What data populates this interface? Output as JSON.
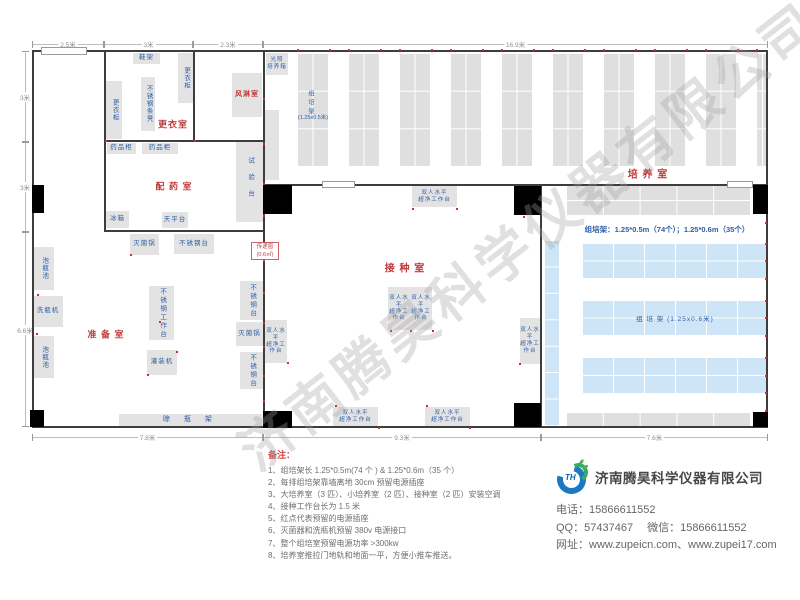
{
  "watermark": "济南腾昊科学仪器有限公司",
  "plan": {
    "colors": {
      "wall": "#3d3d3d",
      "equip_gray": "#e3e3e3",
      "rack_gray": "#dfdfdf",
      "rack_blue": "#cde5f6",
      "label_blue": "#2e5fa6",
      "accent_red": "#c03a3a",
      "outlet_red": "#d12f2f"
    },
    "walls": [
      [
        32,
        50,
        736,
        2
      ],
      [
        32,
        426,
        736,
        2
      ],
      [
        32,
        50,
        2,
        378
      ],
      [
        766,
        50,
        2,
        378
      ],
      [
        104,
        51,
        2,
        181
      ],
      [
        193,
        51,
        2,
        91
      ],
      [
        105,
        140,
        160,
        2
      ],
      [
        105,
        230,
        160,
        2
      ],
      [
        263,
        51,
        2,
        376
      ],
      [
        264,
        184,
        504,
        2
      ],
      [
        540,
        186,
        2,
        241
      ]
    ],
    "doors": [
      [
        32,
        185,
        12,
        28
      ],
      [
        30,
        410,
        14,
        17
      ],
      [
        263,
        185,
        29,
        29
      ],
      [
        263,
        411,
        29,
        17
      ],
      [
        514,
        186,
        27,
        29
      ],
      [
        514,
        403,
        27,
        24
      ],
      [
        753,
        185,
        15,
        29
      ],
      [
        753,
        412,
        15,
        15
      ]
    ],
    "openings": [
      [
        41,
        47,
        46,
        8
      ],
      [
        322,
        181,
        33,
        7
      ],
      [
        727,
        181,
        26,
        7
      ]
    ],
    "rack_columns": {
      "y": 53,
      "h": 113,
      "w": 31,
      "rows": 3,
      "cols": 2,
      "clip": 768,
      "xs": [
        297,
        348,
        399,
        450,
        501,
        552,
        603,
        654,
        705,
        756
      ]
    },
    "grids": [
      {
        "x": 566,
        "y": 185,
        "w": 184,
        "h": 30,
        "r": 2,
        "c": 5,
        "b": "g"
      },
      {
        "x": 566,
        "y": 412,
        "w": 184,
        "h": 15,
        "r": 1,
        "c": 5,
        "b": "g"
      },
      {
        "x": 582,
        "y": 243,
        "w": 186,
        "h": 35,
        "r": 2,
        "c": 6,
        "b": "b"
      },
      {
        "x": 582,
        "y": 300,
        "w": 186,
        "h": 35,
        "r": 2,
        "c": 6,
        "b": "b",
        "t": "组 培 架 (1.25x0.6米)"
      },
      {
        "x": 582,
        "y": 357,
        "w": 186,
        "h": 36,
        "r": 2,
        "c": 6,
        "b": "b"
      },
      {
        "x": 544,
        "y": 240,
        "w": 15,
        "h": 185,
        "r": 7,
        "c": 1,
        "b": "b"
      }
    ],
    "equipment": [
      {
        "n": "shoe-rack",
        "t": "鞋架",
        "x": 133,
        "y": 53,
        "w": 27,
        "h": 11
      },
      {
        "n": "wardrobe",
        "t": "更衣柜",
        "x": 178,
        "y": 53,
        "w": 15,
        "h": 50,
        "v": 1
      },
      {
        "n": "steel-strip-bench",
        "t": "不锈钢条凳",
        "x": 141,
        "y": 77,
        "w": 14,
        "h": 54,
        "v": 1
      },
      {
        "n": "wardrobe",
        "t": "更衣柜",
        "x": 106,
        "y": 81,
        "w": 16,
        "h": 58,
        "v": 1
      },
      {
        "n": "air-shower",
        "t": "风淋室",
        "x": 232,
        "y": 73,
        "w": 30,
        "h": 44,
        "red": 1,
        "fs": 7
      },
      {
        "n": "light-incubator",
        "t": "光照\n培养箱",
        "x": 266,
        "y": 53,
        "w": 22,
        "h": 22,
        "fs": 5.5
      },
      {
        "n": "culture-rack",
        "t": "",
        "x": 265,
        "y": 110,
        "w": 14,
        "h": 70
      },
      {
        "n": "medicine-cabinet",
        "t": "药品柜",
        "x": 107,
        "y": 143,
        "w": 29,
        "h": 11
      },
      {
        "n": "medicine-cabinet",
        "t": "药品柜",
        "x": 142,
        "y": 143,
        "w": 36,
        "h": 11
      },
      {
        "n": "test-bench",
        "t": "试验台",
        "x": 236,
        "y": 142,
        "w": 27,
        "h": 80,
        "v": 1,
        "ls": 10
      },
      {
        "n": "fridge",
        "t": "冰箱",
        "x": 106,
        "y": 211,
        "w": 23,
        "h": 17
      },
      {
        "n": "balance-table",
        "t": "天平台",
        "x": 162,
        "y": 212,
        "w": 26,
        "h": 16
      },
      {
        "n": "sterilizer",
        "t": "灭菌锅",
        "x": 130,
        "y": 234,
        "w": 29,
        "h": 21
      },
      {
        "n": "steel-table",
        "t": "不锈钢台",
        "x": 174,
        "y": 234,
        "w": 40,
        "h": 20
      },
      {
        "n": "bottle-soak-pool",
        "t": "泡瓶池",
        "x": 33,
        "y": 247,
        "w": 21,
        "h": 43,
        "v": 1
      },
      {
        "n": "bottle-washer",
        "t": "洗瓶机",
        "x": 33,
        "y": 296,
        "w": 30,
        "h": 31
      },
      {
        "n": "bottle-soak-pool",
        "t": "泡瓶池",
        "x": 33,
        "y": 336,
        "w": 21,
        "h": 42,
        "v": 1
      },
      {
        "n": "steel-worktable",
        "t": "不锈钢工作台",
        "x": 149,
        "y": 286,
        "w": 25,
        "h": 54,
        "v": 1,
        "ls": 2
      },
      {
        "n": "filling-machine",
        "t": "灌装机",
        "x": 147,
        "y": 350,
        "w": 30,
        "h": 25
      },
      {
        "n": "steel-table",
        "t": "不锈钢台",
        "x": 240,
        "y": 281,
        "w": 23,
        "h": 39,
        "v": 1,
        "ls": 2
      },
      {
        "n": "sterilizer",
        "t": "灭菌锅",
        "x": 236,
        "y": 322,
        "w": 27,
        "h": 24
      },
      {
        "n": "steel-table",
        "t": "不锈钢台",
        "x": 240,
        "y": 352,
        "w": 23,
        "h": 37,
        "v": 1,
        "ls": 2
      },
      {
        "n": "bottle-drying-rack",
        "t": "晾 瓶 架",
        "x": 119,
        "y": 414,
        "w": 143,
        "h": 13,
        "ls": 6,
        "fs": 7
      },
      {
        "n": "clean-bench",
        "t": "双人水平\n超净工作台",
        "x": 412,
        "y": 186,
        "w": 45,
        "h": 21,
        "fs": 5.5
      },
      {
        "n": "clean-bench",
        "t": "双人水平\n超净工作台",
        "x": 265,
        "y": 320,
        "w": 22,
        "h": 43,
        "fs": 5.5
      },
      {
        "n": "clean-bench",
        "t": "双人水平\n超净工作台",
        "x": 388,
        "y": 287,
        "w": 22,
        "h": 43,
        "fs": 5.5
      },
      {
        "n": "clean-bench",
        "t": "双人水平\n超净工作台",
        "x": 410,
        "y": 287,
        "w": 22,
        "h": 43,
        "fs": 5.5
      },
      {
        "n": "clean-bench",
        "t": "双人水平\n超净工作台",
        "x": 520,
        "y": 318,
        "w": 20,
        "h": 46,
        "fs": 5.5
      },
      {
        "n": "clean-bench",
        "t": "双人水平\n超净工作台",
        "x": 333,
        "y": 407,
        "w": 45,
        "h": 20,
        "fs": 5.5
      },
      {
        "n": "clean-bench",
        "t": "双人水平\n超净工作台",
        "x": 425,
        "y": 407,
        "w": 45,
        "h": 20,
        "fs": 5.5
      }
    ],
    "room_labels": [
      {
        "id": "locker-room",
        "t": "更衣室",
        "cx": 173,
        "cy": 124,
        "fs": 9
      },
      {
        "id": "dispensing-room",
        "t": "配 药 室",
        "cx": 174,
        "cy": 186,
        "fs": 9
      },
      {
        "id": "prep-room",
        "t": "准 备 室",
        "cx": 106,
        "cy": 334,
        "fs": 9
      },
      {
        "id": "inoculation-room",
        "t": "接 种 室",
        "cx": 405,
        "cy": 267,
        "fs": 10
      },
      {
        "id": "culture-room",
        "t": "培 养 室",
        "cx": 648,
        "cy": 173,
        "fs": 10
      }
    ],
    "annotations": [
      {
        "cls": "ann-blue",
        "n": "rack-count-note",
        "t": "组培架：1.25*0.5m（74个）；1.25*0.6m（35个）",
        "x": 575,
        "y": 224,
        "w": 184,
        "fs": 7.5
      },
      {
        "cls": "ann-vert",
        "n": "rack-label-vertical",
        "t": "组培架",
        "x": 306,
        "y": 90,
        "fs": 6
      },
      {
        "cls": "ann-small",
        "n": "rack-size-label",
        "t": "(1.25x0.5米)",
        "x": 291,
        "y": 113,
        "w": 44,
        "fs": 5.5
      }
    ],
    "transfer_window": {
      "line1": "传递窗",
      "line2": "(0.6㎡)",
      "x": 251,
      "y": 242,
      "w": 28,
      "h": 18
    },
    "outlets": [
      [
        297,
        49
      ],
      [
        329,
        49
      ],
      [
        348,
        49
      ],
      [
        380,
        49
      ],
      [
        399,
        49
      ],
      [
        431,
        49
      ],
      [
        450,
        49
      ],
      [
        482,
        49
      ],
      [
        501,
        49
      ],
      [
        533,
        49
      ],
      [
        552,
        49
      ],
      [
        584,
        49
      ],
      [
        603,
        49
      ],
      [
        635,
        49
      ],
      [
        654,
        49
      ],
      [
        686,
        49
      ],
      [
        705,
        49
      ],
      [
        737,
        49
      ],
      [
        756,
        49
      ],
      [
        263,
        98
      ],
      [
        263,
        143
      ],
      [
        263,
        183
      ],
      [
        263,
        215
      ],
      [
        263,
        243
      ],
      [
        263,
        260
      ],
      [
        263,
        292
      ],
      [
        263,
        322
      ],
      [
        263,
        346
      ],
      [
        263,
        375
      ],
      [
        263,
        400
      ],
      [
        765,
        222
      ],
      [
        765,
        243
      ],
      [
        765,
        260
      ],
      [
        765,
        278
      ],
      [
        765,
        300
      ],
      [
        765,
        317
      ],
      [
        765,
        335
      ],
      [
        765,
        357
      ],
      [
        765,
        375
      ],
      [
        765,
        392
      ],
      [
        765,
        410
      ],
      [
        130,
        254
      ],
      [
        159,
        321
      ],
      [
        147,
        374
      ],
      [
        176,
        351
      ],
      [
        37,
        294
      ],
      [
        36,
        333
      ],
      [
        390,
        330
      ],
      [
        410,
        330
      ],
      [
        432,
        330
      ],
      [
        412,
        208
      ],
      [
        456,
        208
      ],
      [
        287,
        362
      ],
      [
        519,
        363
      ],
      [
        335,
        405
      ],
      [
        378,
        427
      ],
      [
        426,
        405
      ],
      [
        469,
        427
      ],
      [
        523,
        216
      ],
      [
        105,
        140
      ],
      [
        194,
        140
      ]
    ],
    "dims": [
      {
        "o": "h",
        "label": "2.5米",
        "a": 32,
        "b": 104,
        "c": 44
      },
      {
        "o": "h",
        "label": "3米",
        "a": 104,
        "b": 193,
        "c": 44
      },
      {
        "o": "h",
        "label": "2.3米",
        "a": 193,
        "b": 263,
        "c": 44
      },
      {
        "o": "h",
        "label": "16.9米",
        "a": 263,
        "b": 768,
        "c": 44
      },
      {
        "o": "v",
        "label": "3米",
        "a": 51,
        "b": 142,
        "c": 25
      },
      {
        "o": "v",
        "label": "3米",
        "a": 142,
        "b": 232,
        "c": 25
      },
      {
        "o": "v",
        "label": "6.6米",
        "a": 232,
        "b": 427,
        "c": 25
      },
      {
        "o": "h",
        "label": "7.8米",
        "a": 32,
        "b": 263,
        "c": 437
      },
      {
        "o": "h",
        "label": "9.3米",
        "a": 263,
        "b": 541,
        "c": 437
      },
      {
        "o": "h",
        "label": "7.6米",
        "a": 541,
        "b": 768,
        "c": 437
      }
    ]
  },
  "notes": {
    "title": "备注：",
    "items": [
      "1、组培架长 1.25*0.5m(74 个 ) & 1.25*0.6m（35 个）",
      "2、每排组培架靠墙离地 30cm 预留电源插座",
      "3、大培养室（3 匹）、小培养室（2 匹）、接种室（2 匹）安装空调",
      "4、接种工作台长为 1.5 米",
      "5、红点代表预留的电源插座",
      "6、灭菌器和洗瓶机预留 380v 电源接口",
      "7、整个组培室预留电源功率 >300kw",
      "8、培养室推拉门地轨和地面一平，方便小推车推送。"
    ]
  },
  "company": {
    "logo_text": "TH",
    "name": "济南腾昊科学仪器有限公司",
    "phone_label": "电话：",
    "phone": "15866611552",
    "qq_label": "QQ：",
    "qq": "57437467",
    "wechat_label": "微信：",
    "wechat": "15866611552",
    "web_label": "网址：",
    "websites": "www.zupeicn.com、www.zupei17.com"
  }
}
